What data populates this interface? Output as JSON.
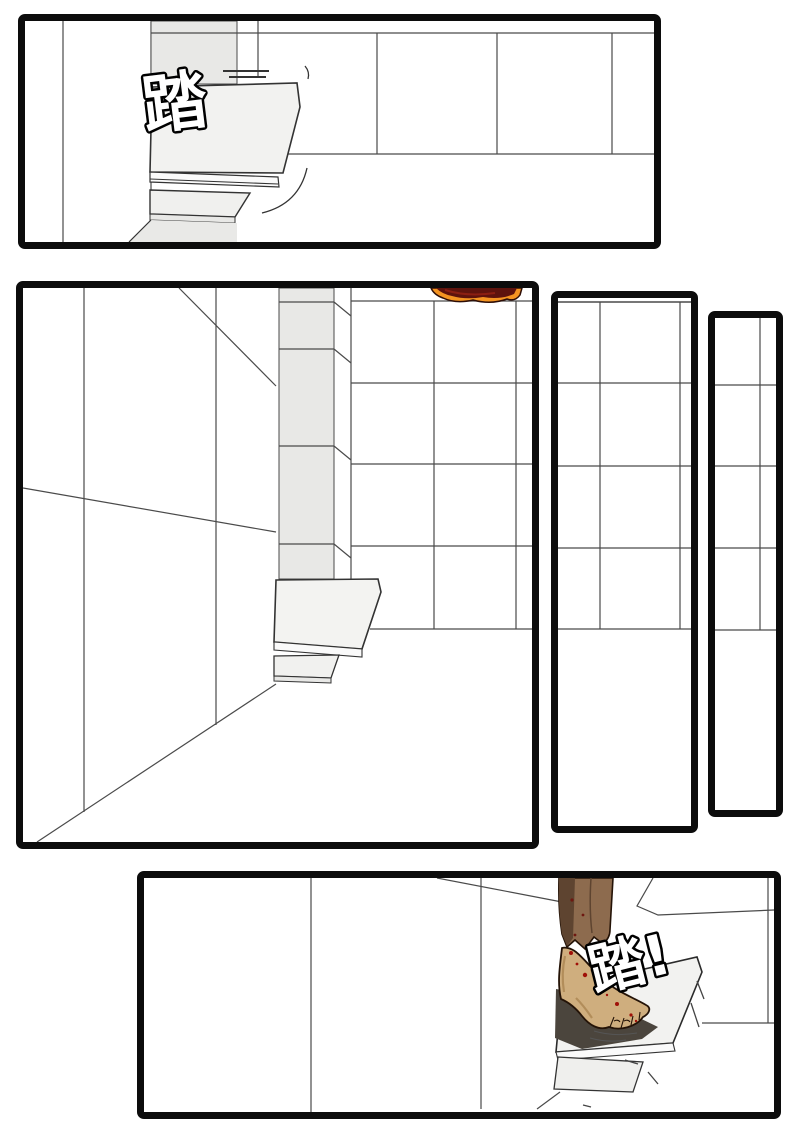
{
  "page": {
    "kind": "manga page",
    "background": "#ffffff",
    "panel_count": 5
  },
  "sfx": {
    "panel1_stomp": {
      "text": "踏",
      "style": "white fill, black outline, tilted"
    },
    "panel5_stomp": {
      "text": "踏!",
      "style": "white fill, black outline, tilted"
    }
  },
  "panels": [
    {
      "name": "panel-1",
      "scene": "close-up of stair steps jutting from a tiled pillar, tiled wall behind, stomp sound effect at left"
    },
    {
      "name": "panel-2",
      "scene": "tall stairwell corner: left wall, segmented pillar, tiled wall, small steps; top of a dark-red haired head peeks over the top edge"
    },
    {
      "name": "panel-3",
      "scene": "narrow tall panel of blank tiled wall"
    },
    {
      "name": "panel-4",
      "scene": "narrowest tall panel of blank tiled wall"
    },
    {
      "name": "panel-5",
      "scene": "bare wounded foot under a brown robe hem stomping onto a stone step, tiled wall at right, stomp sound effect"
    }
  ],
  "colors": {
    "panel_border": "#0c0c0c",
    "line": "#4a4a4a",
    "tile_gray": "#e8e8e6",
    "step_face": "#f2f2f0",
    "hair_dark": "#5e130d",
    "hair_red": "#8c1f12",
    "hair_orange": "#f49421",
    "robe_light": "#8d6b4e",
    "robe_dark": "#5e4430",
    "skin": "#cfae7e",
    "skin_shadow": "#a9834f",
    "blood": "#a01008",
    "cast_shadow": "#4b453d"
  }
}
